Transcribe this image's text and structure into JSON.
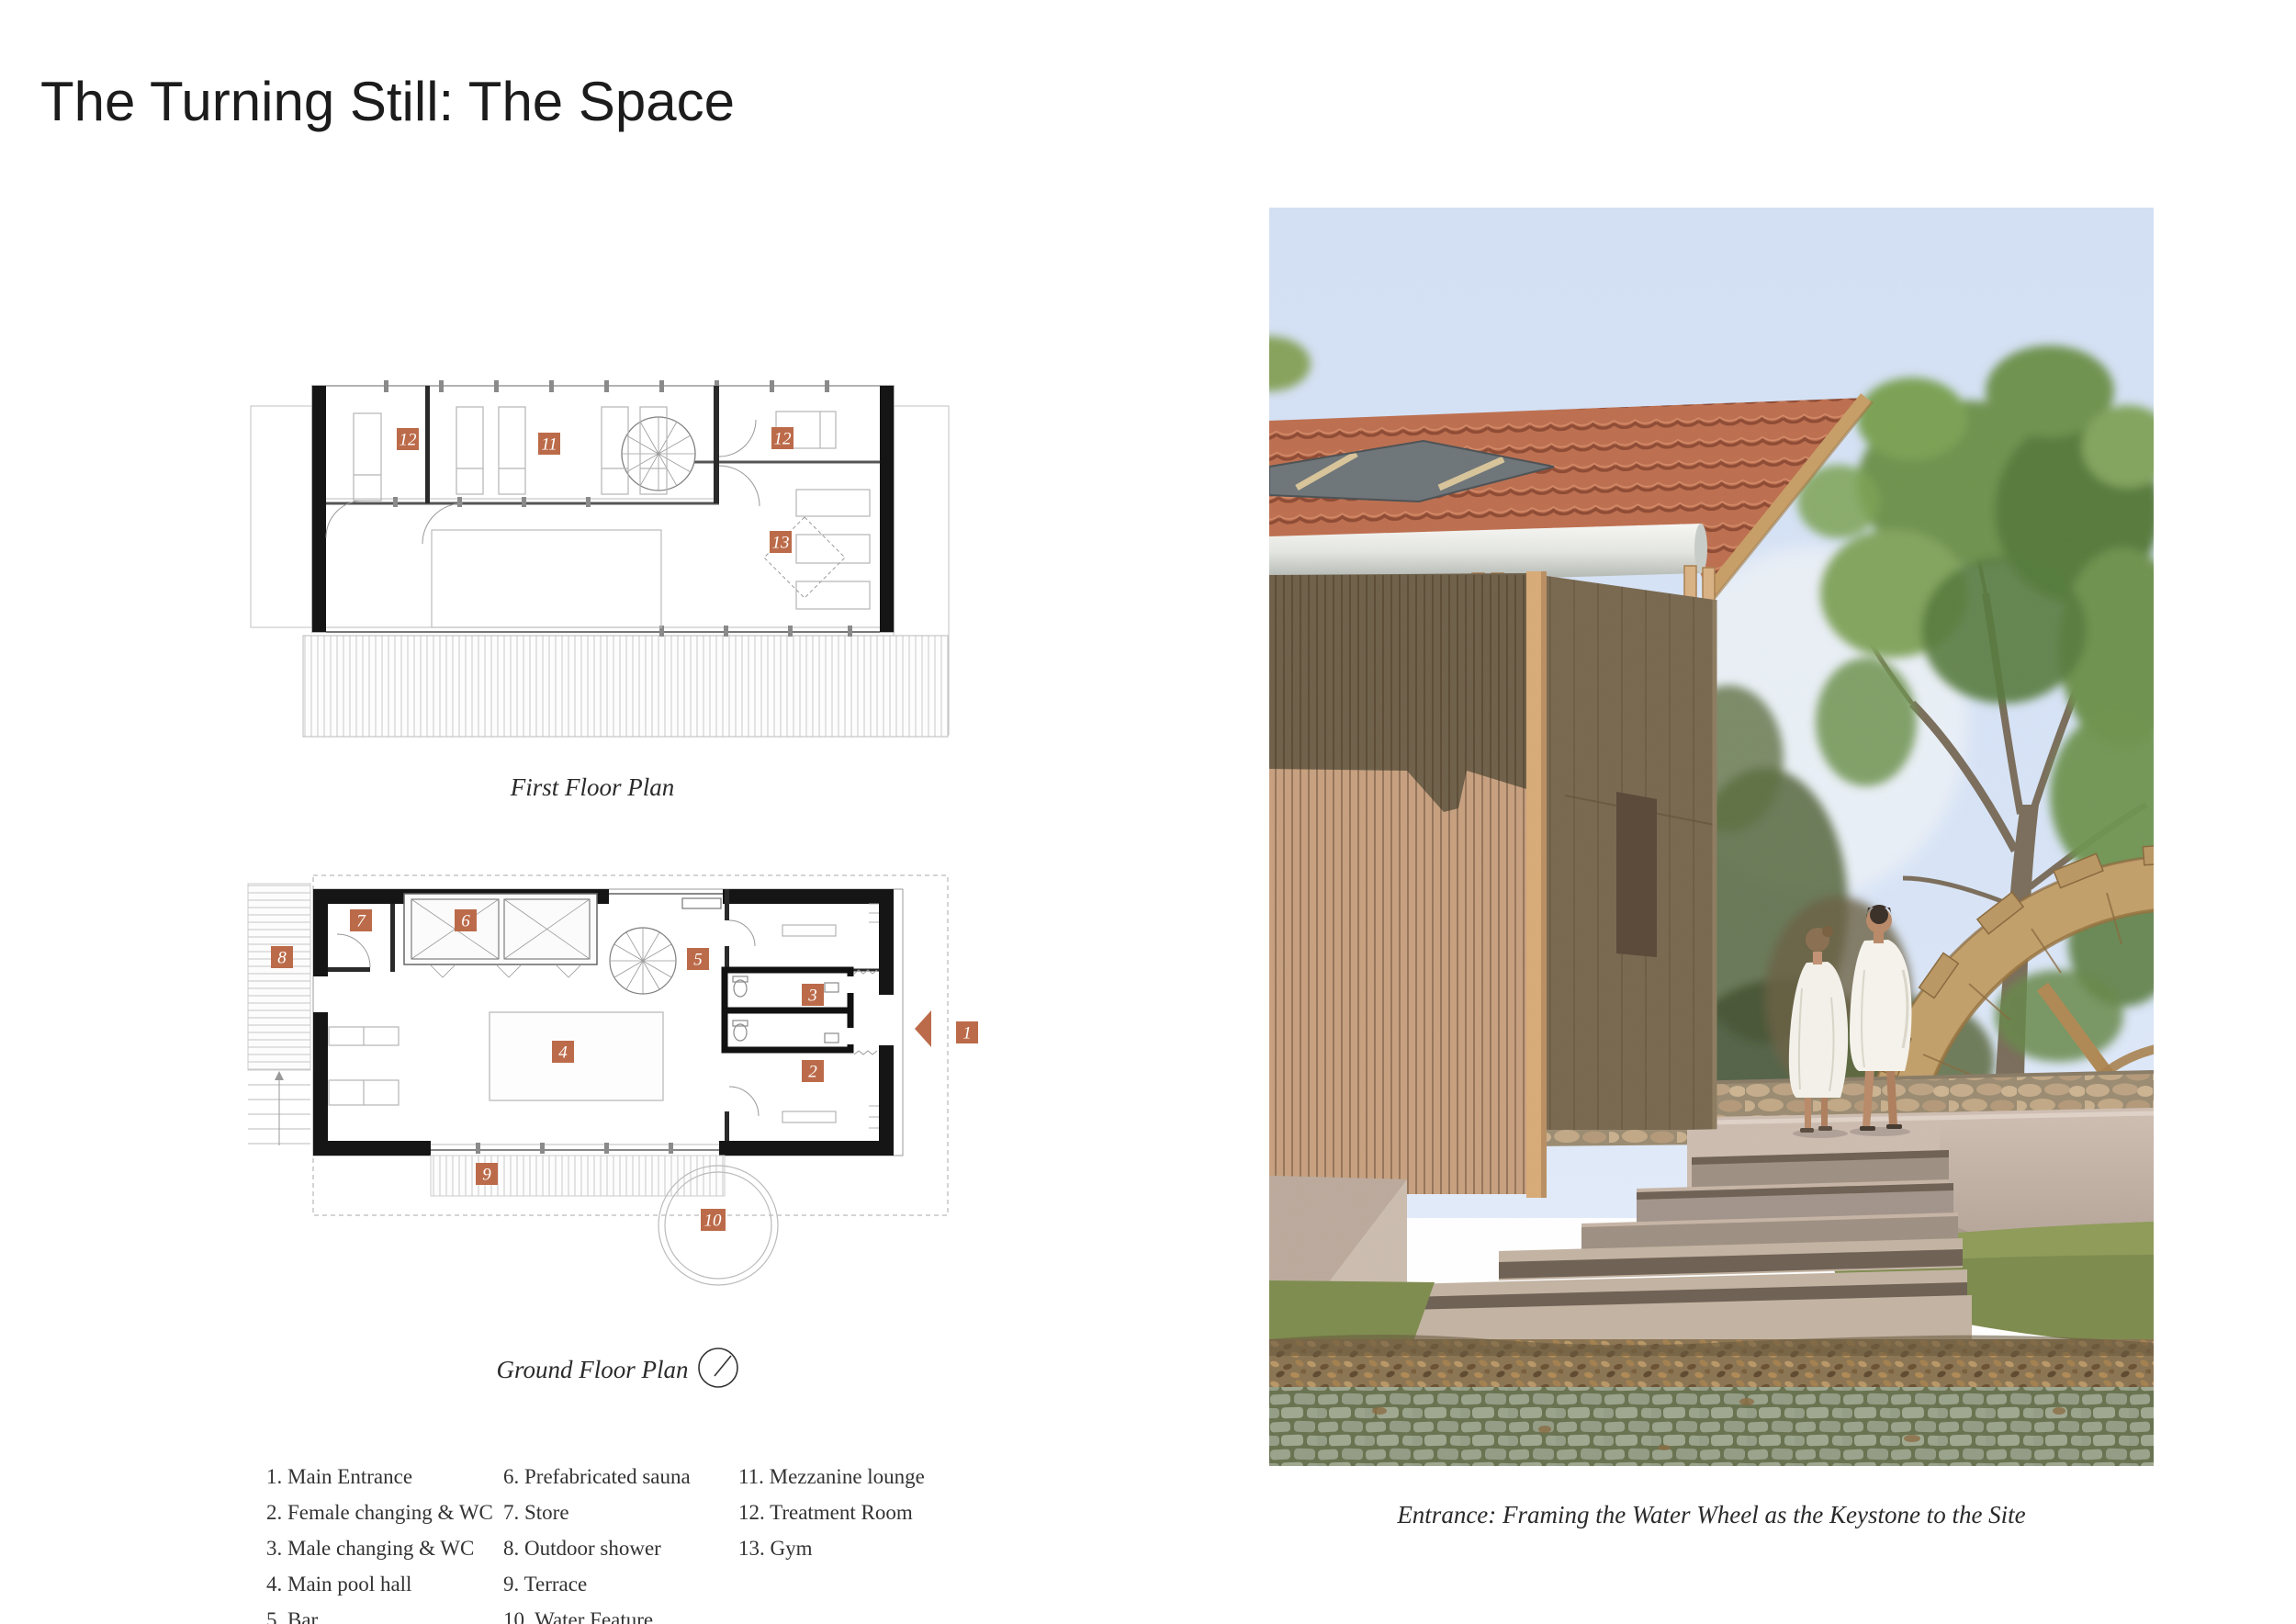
{
  "title": "The Turning Still: The Space",
  "accent_color": "#bc6b4a",
  "plans": {
    "first_floor": {
      "caption": "First Floor Plan",
      "labels": [
        "12",
        "11",
        "12",
        "13"
      ]
    },
    "ground_floor": {
      "caption": "Ground Floor Plan",
      "labels": [
        "7",
        "6",
        "5",
        "3",
        "2",
        "4",
        "1",
        "8",
        "9",
        "10"
      ]
    }
  },
  "legend": {
    "columns": [
      {
        "items": [
          "1. Main Entrance",
          "2. Female changing & WC",
          "3. Male changing & WC",
          "4. Main pool hall",
          "5. Bar"
        ]
      },
      {
        "items": [
          "6. Prefabricated sauna",
          "7. Store",
          "8. Outdoor shower",
          "9. Terrace",
          "10. Water Feature"
        ]
      },
      {
        "items": [
          "11. Mezzanine lounge",
          "12. Treatment Room",
          "13. Gym"
        ]
      }
    ]
  },
  "render": {
    "caption": "Entrance: Framing the Water Wheel as the Keystone to the Site"
  }
}
